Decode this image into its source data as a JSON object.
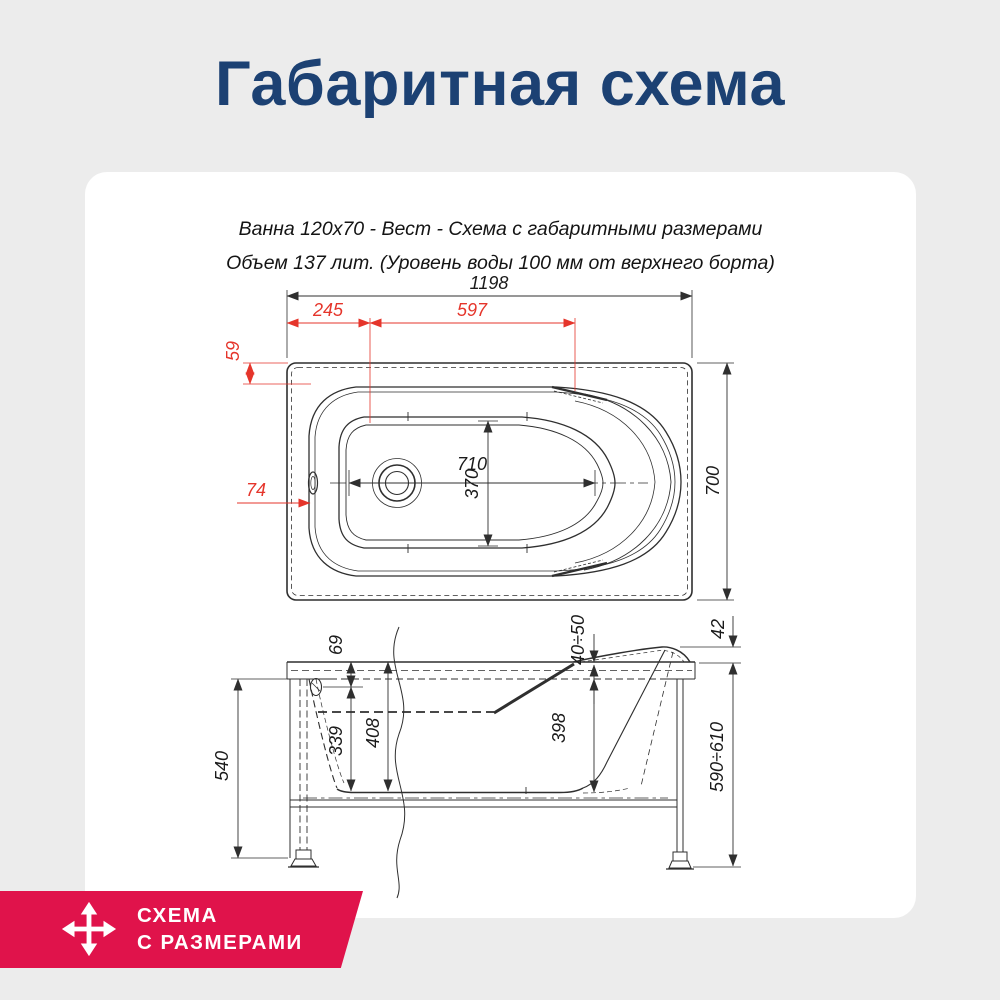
{
  "title": {
    "text": "Габаритная схема",
    "color": "#1c4173"
  },
  "card": {
    "caption_line1": "Ванна 120х70 - Вест - Схема с габаритными размерами",
    "caption_line2": "Объем 137 лит. (Уровень воды 100 мм от верхнего борта)"
  },
  "drawing": {
    "top_view": {
      "overall_length": "1198",
      "left_segment": "245",
      "middle_segment": "597",
      "rim_top_offset": "59",
      "rim_left_offset": "74",
      "basin_length": "710",
      "basin_width": "370",
      "overall_width": "700"
    },
    "side_view": {
      "rim_to_overflow": "69",
      "overflow_to_bottom": "339",
      "rim_to_bottom": "408",
      "back_wall_depth": "398",
      "skirt_height": "540",
      "headrest_rise": "42",
      "rim_thickness": "40÷50",
      "floor_to_rim_height": "590÷610"
    },
    "colors": {
      "line": "#2f2f2f",
      "dimension_red": "#e5352b"
    }
  },
  "badge": {
    "line1": "СХЕМА",
    "line2": "С РАЗМЕРАМИ",
    "background": "#e0134b",
    "icon": "move-arrows-icon"
  }
}
